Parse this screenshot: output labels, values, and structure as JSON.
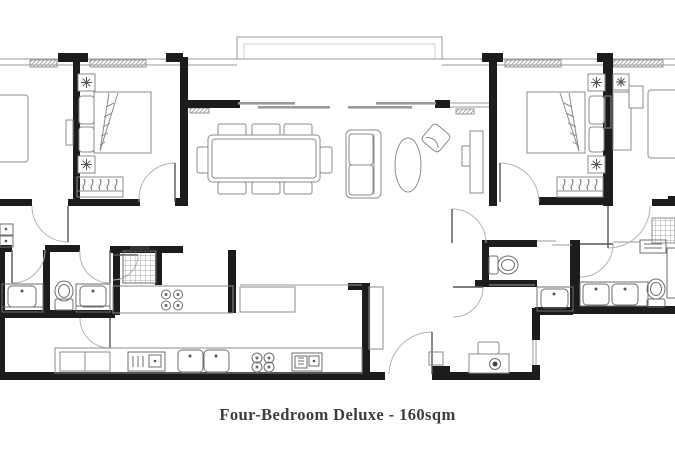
{
  "caption": {
    "text": "Four-Bedroom Deluxe - 160sqm"
  },
  "palette": {
    "wall": "#1c1c1c",
    "furniture_line": "#8b8b8b",
    "fixture_line": "#6e6e6e",
    "structure_line": "#9a9a9a",
    "door_arc": "#b4b4b4",
    "caption_text": "#3d3d3d",
    "background": "#ffffff"
  },
  "plan": {
    "type": "apartment-floor-plan",
    "unit_name": "Four-Bedroom Deluxe",
    "unit_area_label": "160sqm"
  }
}
